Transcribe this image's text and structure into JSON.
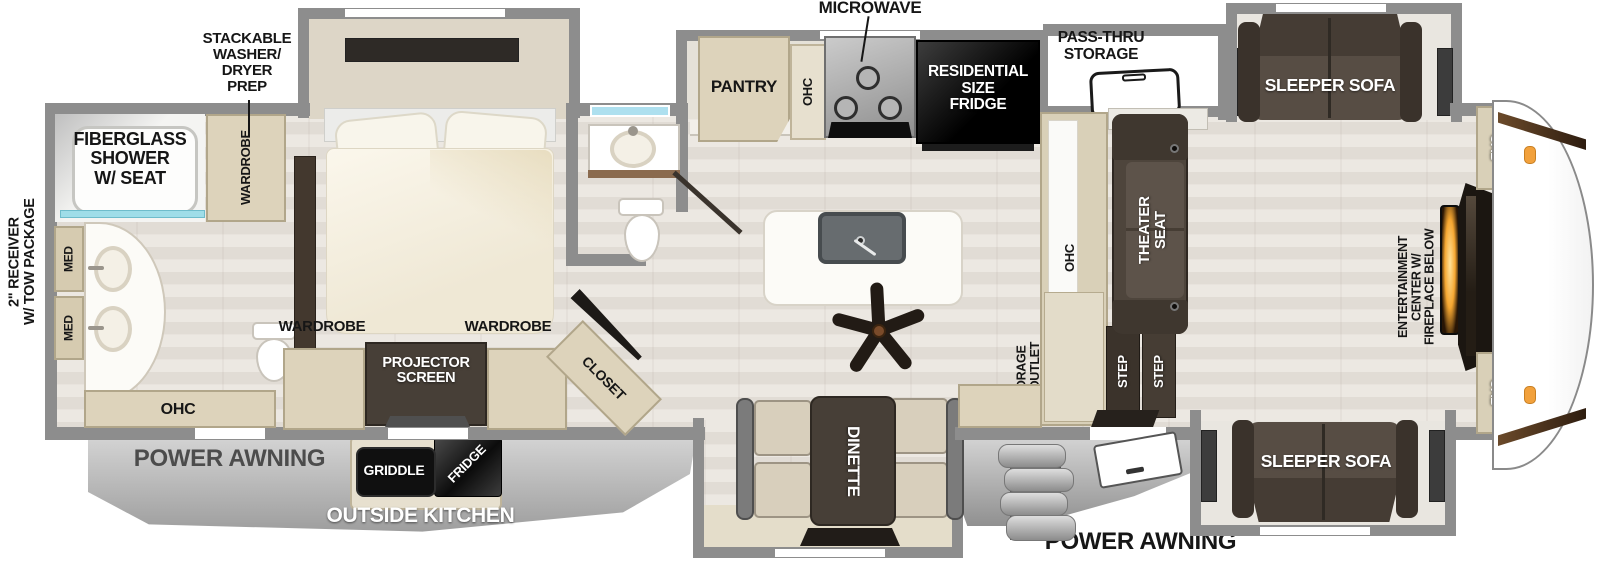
{
  "labels": {
    "microwave": "MICROWAVE",
    "stackable_prep": "STACKABLE\nWASHER/\nDRYER\nPREP",
    "pass_thru_storage": "PASS-THRU\nSTORAGE",
    "fiberglass_shower": "FIBERGLASS\nSHOWER\nW/ SEAT",
    "wardrobe_bath": "WARDROBE",
    "med_upper": "MED",
    "med_lower": "MED",
    "ohc_bath": "OHC",
    "receiver": "2\" RECEIVER\nW/ TOW PACKAGE",
    "pantry": "PANTRY",
    "ohc_kitchen": "OHC",
    "residential_fridge": "RESIDENTIAL\nSIZE\nFRIDGE",
    "sleeper_sofa_top": "SLEEPER SOFA",
    "sleeper_sofa_bottom": "SLEEPER SOFA",
    "theater_seat": "THEATER\nSEAT",
    "ohc_living": "OHC",
    "storage_outlet": "STORAGE\nW/ OUTLET",
    "step_1": "STEP",
    "step_2": "STEP",
    "cab_top": "CAB",
    "cab_bottom": "CAB",
    "entertainment": "ENTERTAINMENT\nCENTER W/\nFIREPLACE BELOW",
    "wardrobe_bed_left": "WARDROBE",
    "wardrobe_bed_right": "WARDROBE",
    "projector_screen": "PROJECTOR\nSCREEN",
    "closet": "CLOSET",
    "dinette": "DINETTE",
    "griddle": "GRIDDLE",
    "outside_fridge": "FRIDGE",
    "outside_kitchen": "OUTSIDE KITCHEN",
    "power_awning_left": "POWER AWNING",
    "power_awning_right": "POWER AWNING"
  },
  "colors": {
    "wall_gray": "#8d8d8d",
    "cabinet_beige": "#ddd3bb",
    "dark_furniture": "#473f37",
    "appliance_black": "#141414",
    "shower_glass_aqua": "#9fdde8",
    "fireplace_orange": "#f6a731",
    "awning_gray": "#b9b9b9",
    "window_blue": "#aee0ef",
    "label_black": "#161616",
    "label_white": "#ffffff"
  }
}
